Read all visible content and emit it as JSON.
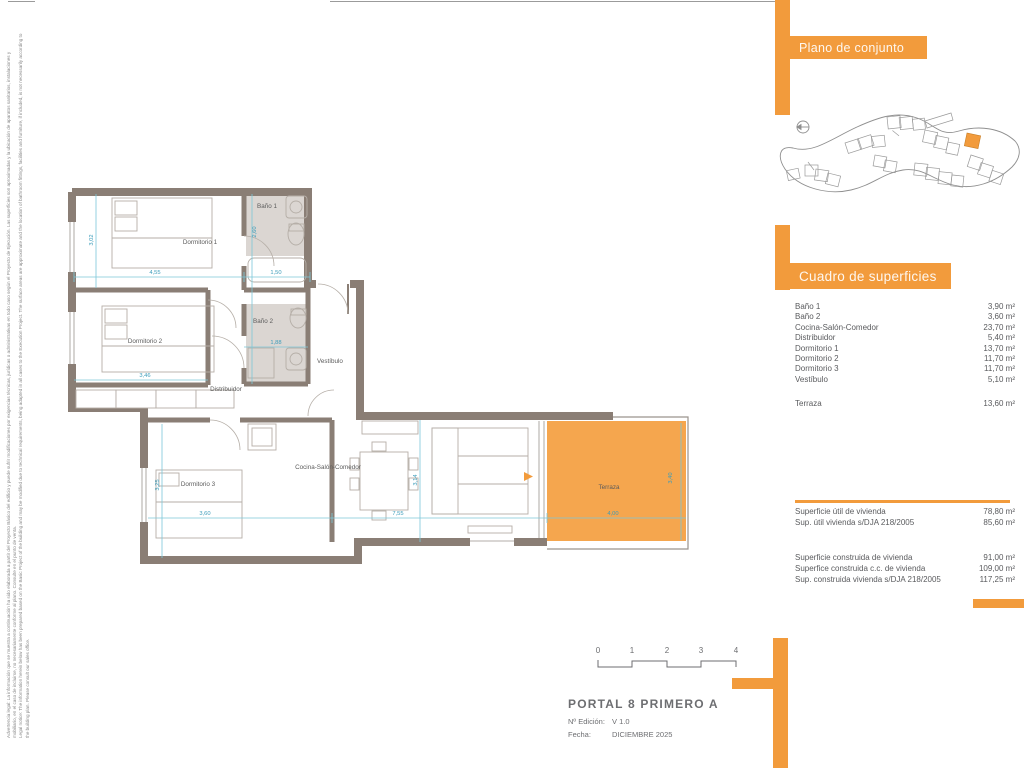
{
  "accent": "#F29B3C",
  "legal": {
    "es": "Advertencia legal: La información que se muestra a continuación ha sido elaborada a partir del Proyecto Básico del edificio y puede sufrir modificaciones por exigencias técnicas, jurídicas o administrativas en todo caso según el Proyecto de Ejecución. Las superficies son aproximadas y la ubicación de aparatos sanitarios, instalaciones y mobiliario, en el caso de incluirse, no necesariamente conforme al plano. Consulte en el punto de venta.",
    "en": "Legal notice: The information herein below has been prepared based on the Basic Project of the building and may be modified due to technical requirements, being adapted in all cases to the Execution Project. The surface areas are approximate and the location of bathroom fittings, facilities and furniture, if included, is not necessarily according to the building plan. Please consult our sales office."
  },
  "site_panel": {
    "title": "Plano de conjunto"
  },
  "surfaces_panel": {
    "title": "Cuadro de superficies",
    "rows": [
      {
        "label": "Baño 1",
        "value": "3,90 m²"
      },
      {
        "label": "Baño 2",
        "value": "3,60 m²"
      },
      {
        "label": "Cocina-Salón-Comedor",
        "value": "23,70 m²"
      },
      {
        "label": "Distribuidor",
        "value": "5,40 m²"
      },
      {
        "label": "Dormitorio 1",
        "value": "13,70 m²"
      },
      {
        "label": "Dormitorio 2",
        "value": "11,70 m²"
      },
      {
        "label": "Dormitorio 3",
        "value": "11,70 m²"
      },
      {
        "label": "Vestíbulo",
        "value": "5,10 m²"
      }
    ],
    "terrace": {
      "label": "Terraza",
      "value": "13,60 m²"
    },
    "useful": [
      {
        "label": "Superficie útil de vivienda",
        "value": "78,80 m²"
      },
      {
        "label": "Sup. útil vivienda s/DJA 218/2005",
        "value": "85,60 m²"
      }
    ],
    "built": [
      {
        "label": "Superficie construida de vivienda",
        "value": "91,00 m²"
      },
      {
        "label": "Superfice construida c.c. de vivienda",
        "value": "109,00 m²"
      },
      {
        "label": "Sup. construida vivienda s/DJA 218/2005",
        "value": "117,25 m²"
      }
    ]
  },
  "title_block": {
    "title": "PORTAL 8 PRIMERO A",
    "edition_label": "Nº Edición:",
    "edition_value": "V 1.0",
    "date_label": "Fecha:",
    "date_value": "DICIEMBRE 2025"
  },
  "scale_bar": {
    "ticks": [
      "0",
      "1",
      "2",
      "3",
      "4"
    ]
  },
  "plan": {
    "rooms": [
      "Dormitorio 1",
      "Baño 1",
      "Dormitorio 2",
      "Baño 2",
      "Vestíbulo",
      "Distribuidor",
      "Dormitorio 3",
      "Cocina-Salón-Comedor",
      "Terraza"
    ],
    "dims": [
      "4,55",
      "1,50",
      "3,02",
      "2,60",
      "3,46",
      "1,88",
      "3,60",
      "3,25",
      "7,55",
      "3,14",
      "4,00",
      "3,40"
    ]
  }
}
